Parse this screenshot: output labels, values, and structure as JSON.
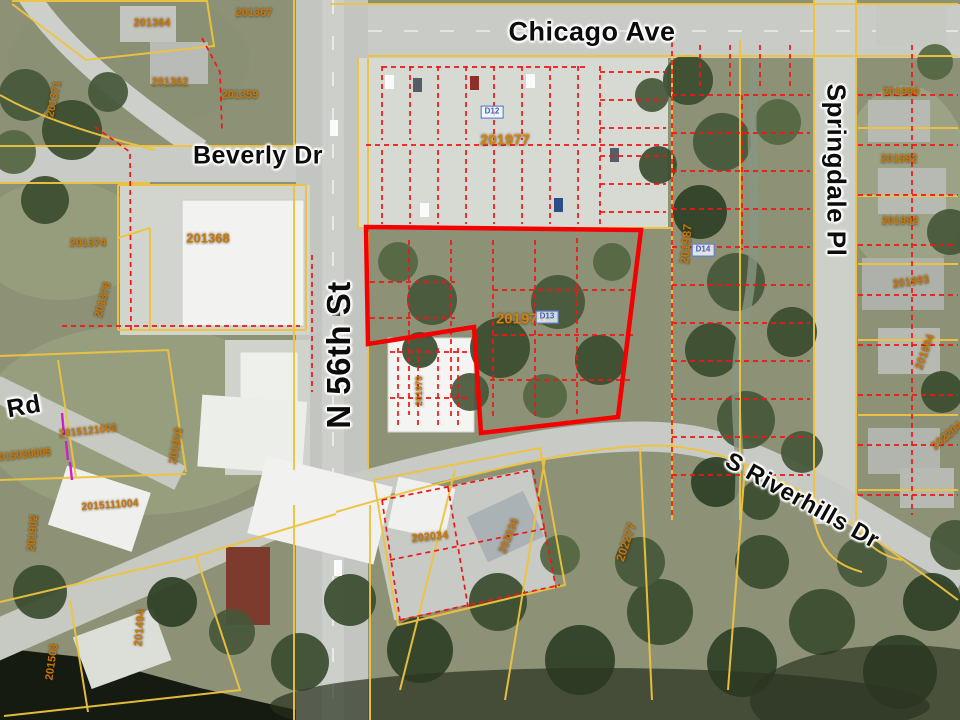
{
  "map": {
    "streets": [
      {
        "text": "Chicago Ave"
      },
      {
        "text": "Beverly Dr"
      },
      {
        "text": "N 56th St"
      },
      {
        "text": "Springdale Pl"
      },
      {
        "text": "S Riverhills Dr"
      },
      {
        "text": "Rd"
      }
    ],
    "parcels": [
      {
        "text": "201364"
      },
      {
        "text": "201367"
      },
      {
        "text": "201362"
      },
      {
        "text": "201359"
      },
      {
        "text": "201371"
      },
      {
        "text": "201368"
      },
      {
        "text": "201374"
      },
      {
        "text": "201378"
      },
      {
        "text": "201977"
      },
      {
        "text": "201978"
      },
      {
        "text": "201987"
      },
      {
        "text": "201990"
      },
      {
        "text": "201992"
      },
      {
        "text": "201992"
      },
      {
        "text": "201993"
      },
      {
        "text": "201994"
      },
      {
        "text": "2015121002"
      },
      {
        "text": "2015030005"
      },
      {
        "text": "201910"
      },
      {
        "text": "2015111004"
      },
      {
        "text": "201902"
      },
      {
        "text": "202034"
      },
      {
        "text": "202036"
      },
      {
        "text": "202277"
      },
      {
        "text": "202204"
      },
      {
        "text": "201979"
      },
      {
        "text": "201503"
      },
      {
        "text": "201494"
      }
    ],
    "markers": [
      {
        "text": "D12"
      },
      {
        "text": "D13"
      },
      {
        "text": "D14"
      }
    ],
    "highlighted_parcel": "201978",
    "colors": {
      "parcel_line": "#eec33f",
      "lot_line": "#f21515",
      "selection_outline": "#ff0000",
      "parcel_label": "#c97708",
      "street_label": "#0c0c0c",
      "marker_blue": "#3a5fc0"
    }
  }
}
